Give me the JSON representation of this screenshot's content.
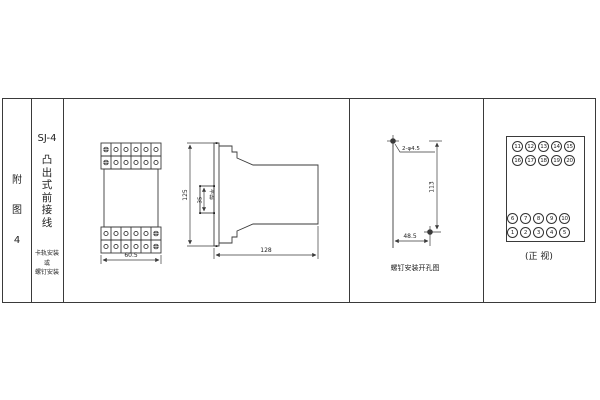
{
  "colors": {
    "bg": "#ffffff",
    "line": "#3a3a3a",
    "text": "#222222"
  },
  "index_column": {
    "chars": [
      "附",
      "图",
      "4"
    ]
  },
  "product_column": {
    "model": "SJ-4",
    "title_chars": [
      "凸",
      "出",
      "式",
      "前",
      "接",
      "线"
    ],
    "mount_lines": [
      "卡轨安装",
      "或",
      "螺钉安装"
    ]
  },
  "outline": {
    "front_width_dim": "60.5",
    "side_height_dim": "125",
    "rail_width_dim": "35",
    "rail_label": "卡轨",
    "side_depth_dim": "128"
  },
  "drill": {
    "holes_label": "2-φ4.5",
    "vertical_dim": "113",
    "horizontal_dim": "48.5",
    "caption": "螺钉安装开孔图"
  },
  "terminals": {
    "top_row1": [
      "11",
      "12",
      "13",
      "14",
      "15"
    ],
    "top_row2": [
      "16",
      "17",
      "18",
      "19",
      "20"
    ],
    "bottom_row1": [
      "6",
      "7",
      "8",
      "9",
      "10"
    ],
    "bottom_row2": [
      "1",
      "2",
      "3",
      "4",
      "5"
    ],
    "caption": "(正 视)"
  }
}
